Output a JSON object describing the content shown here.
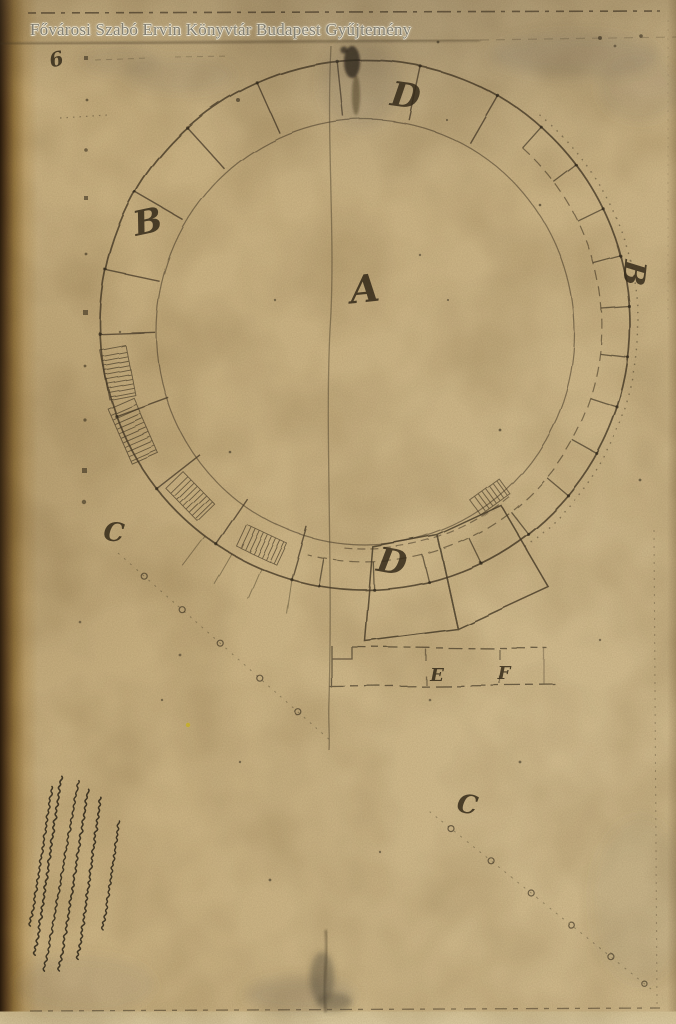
{
  "watermark": "Fővárosi Szabó Ervin Könyvtár Budapest Gyűjtemény",
  "plan": {
    "labels": {
      "center": "A",
      "segment_top": "D",
      "segment_left": "B",
      "segment_right": "B",
      "segment_bottom": "D",
      "guide_left": "C",
      "guide_right": "C",
      "annex_e": "E",
      "annex_f": "F",
      "corner_mark": "6"
    }
  },
  "handwritten_note": "illegible rotated cursive inscription, lower-left margin",
  "colors": {
    "paper": "#ccb587",
    "ink": "#473b28",
    "watermark_gray": "#7e7d74",
    "binding_edge": "#2a1b0b"
  }
}
